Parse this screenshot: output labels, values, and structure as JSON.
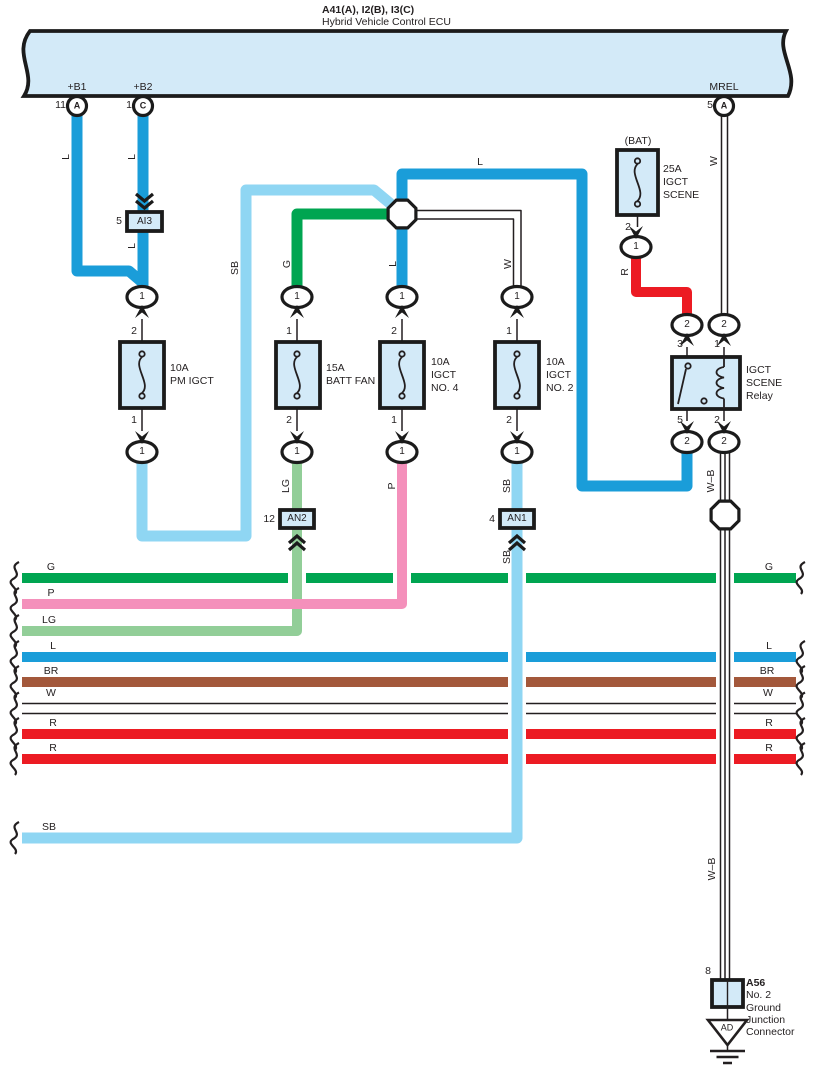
{
  "colors": {
    "blue": "#1A9DD9",
    "sb": "#8FD6F3",
    "green": "#00A551",
    "lg": "#92CE98",
    "pink": "#F490BB",
    "red": "#EC1B23",
    "brown": "#A3583B",
    "fill": "#D3EAF8"
  },
  "title": {
    "line1": "A41(A), I2(B), I3(C)",
    "line2": "Hybrid Vehicle Control ECU"
  },
  "ecu": {
    "b1": {
      "label": "+B1",
      "pin": "11",
      "cavity": "A"
    },
    "b2": {
      "label": "+B2",
      "pin": "1",
      "cavity": "C"
    },
    "mrel": {
      "label": "MREL",
      "pin": "5",
      "cavity": "A"
    }
  },
  "wires": {
    "L": "L",
    "SB": "SB",
    "G": "G",
    "LG": "LG",
    "P": "P",
    "W": "W",
    "R": "R",
    "BR": "BR",
    "WB": "W–B"
  },
  "conn": {
    "n1": "1",
    "n2": "2"
  },
  "blocks": {
    "ai3": {
      "pin": "5",
      "label": "AI3"
    },
    "an2": {
      "pin": "12",
      "label": "AN2"
    },
    "an1": {
      "pin": "4",
      "label": "AN1"
    }
  },
  "fuses": {
    "pm": {
      "rating": "10A",
      "name1": "PM IGCT",
      "pin_top": "2",
      "pin_bot": "1"
    },
    "battfan": {
      "rating": "15A",
      "name1": "BATT FAN",
      "pin_top": "1",
      "pin_bot": "2"
    },
    "no4": {
      "rating": "10A",
      "name1": "IGCT",
      "name2": "NO. 4",
      "pin_top": "2",
      "pin_bot": "1"
    },
    "no2": {
      "rating": "10A",
      "name1": "IGCT",
      "name2": "NO. 2",
      "pin_top": "1",
      "pin_bot": "2"
    },
    "scene": {
      "context": "(BAT)",
      "rating": "25A",
      "name1": "IGCT",
      "name2": "SCENE",
      "pin_bot": "2"
    }
  },
  "relay": {
    "name1": "IGCT",
    "name2": "SCENE",
    "name3": "Relay",
    "pin_tl": "3",
    "pin_tr": "1",
    "pin_bl": "5",
    "pin_br": "2"
  },
  "ground": {
    "pin": "8",
    "code": "A56",
    "name1": "No. 2",
    "name2": "Ground",
    "name3": "Junction",
    "name4": "Connector",
    "mark": "AD"
  }
}
